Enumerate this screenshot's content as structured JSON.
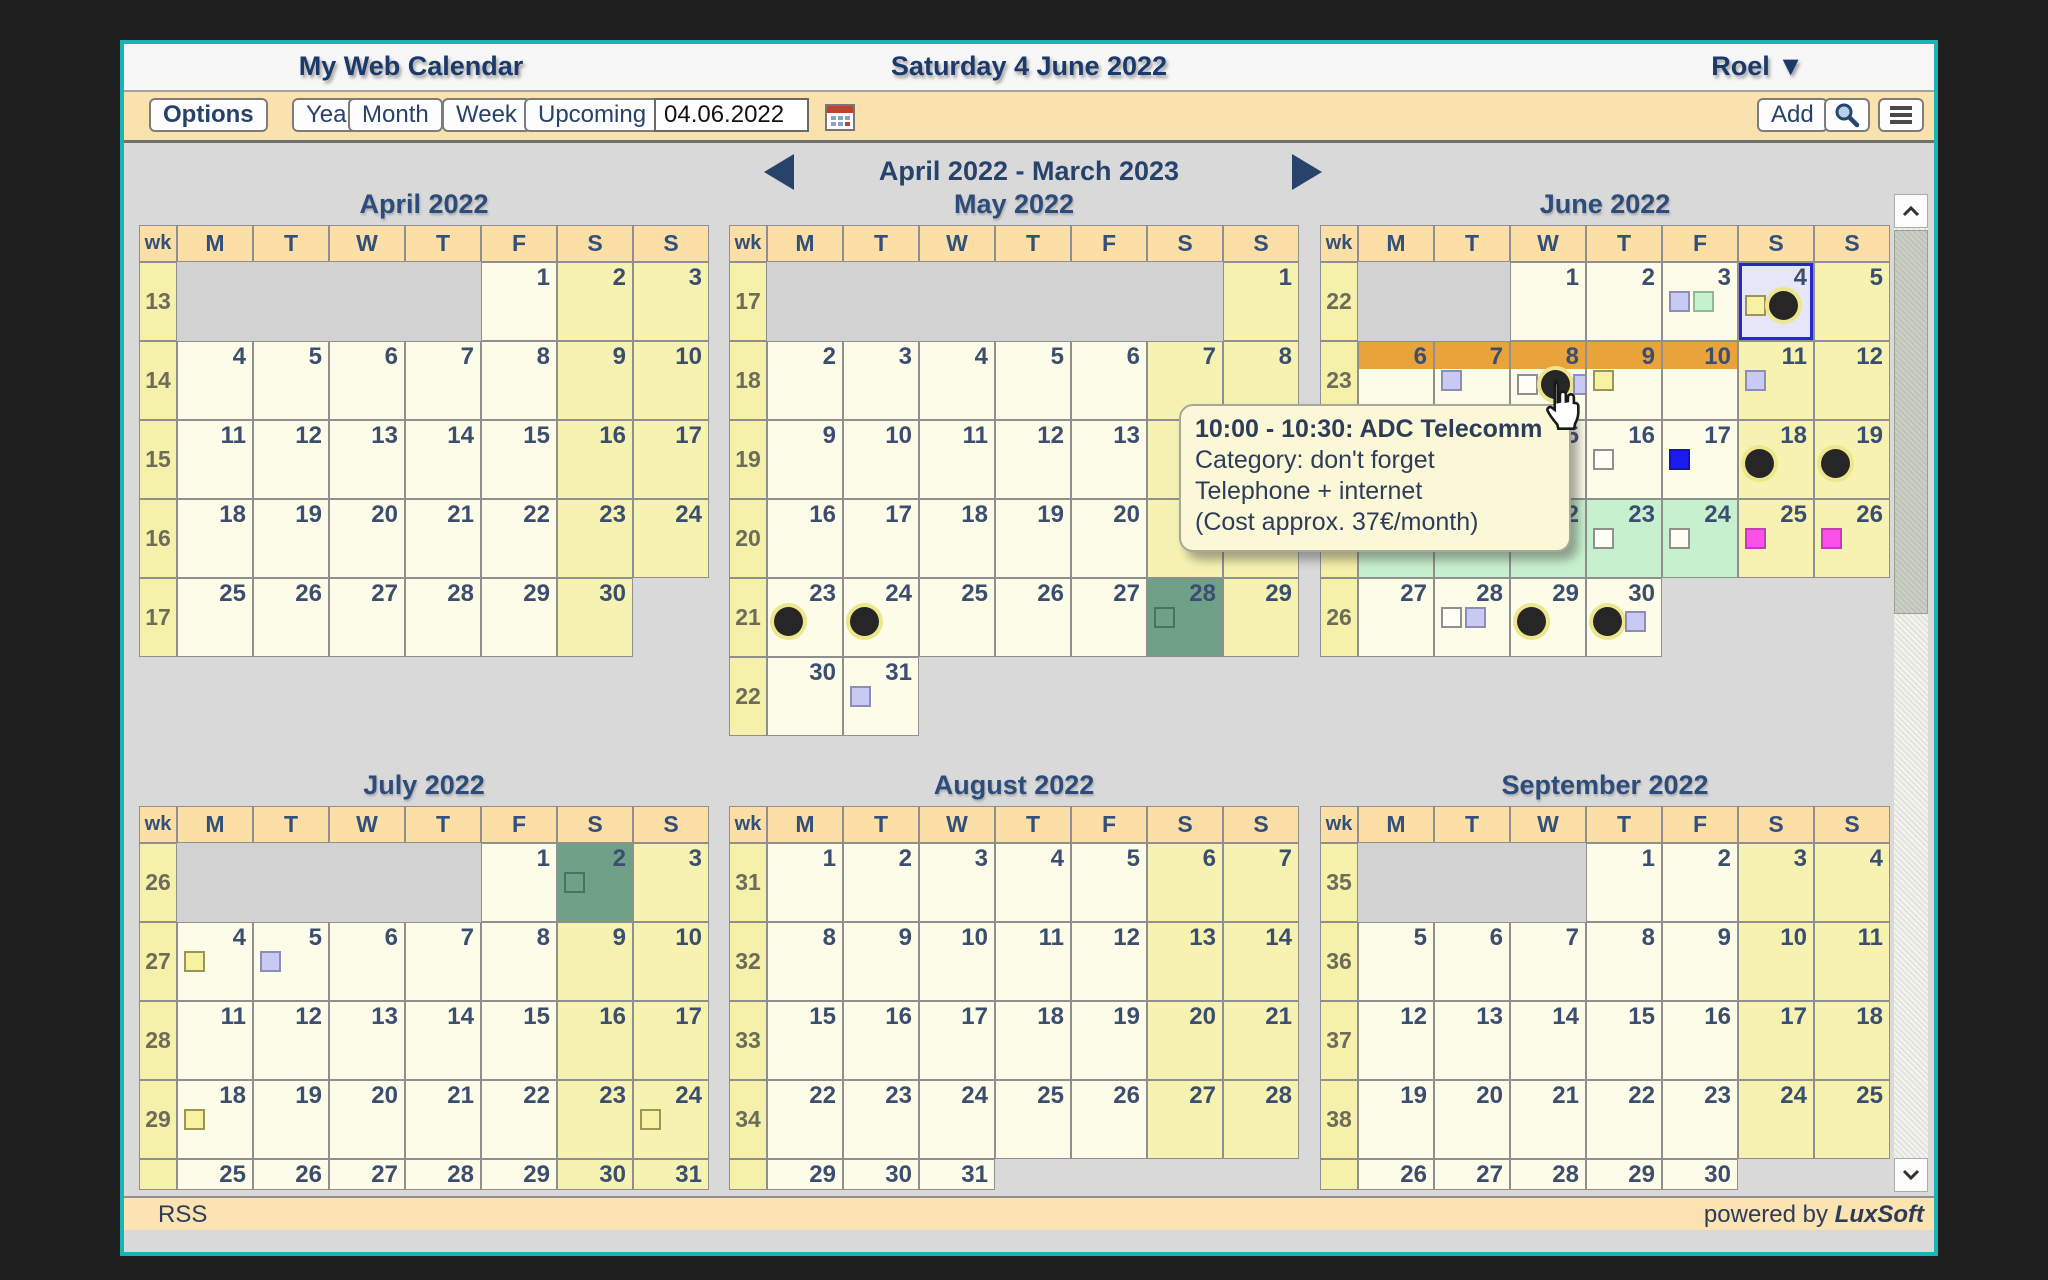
{
  "window": {
    "title_left": "My Web Calendar",
    "title_center": "Saturday 4 June 2022",
    "user": {
      "name": "Roel",
      "caret": "▼"
    }
  },
  "toolbar": {
    "options": "Options",
    "year": "Year",
    "month": "Month",
    "week": "Week",
    "upcoming": "Upcoming",
    "date_value": "04.06.2022",
    "add": "Add"
  },
  "nav": {
    "range_label": "April 2022 - March 2023"
  },
  "weekday_headers": [
    "wk",
    "M",
    "T",
    "W",
    "T",
    "F",
    "S",
    "S"
  ],
  "tooltip": {
    "line1": "10:00 - 10:30: ADC Telecomm",
    "line2": "Category: don't forget",
    "line3": "Telephone + internet",
    "line4": "(Cost approx. 37€/month)"
  },
  "footer": {
    "rss": "RSS",
    "powered_prefix": "powered by ",
    "powered_brand": "LuxSoft"
  },
  "colors": {
    "accent_border": "#1CB3B6",
    "toolbar_bg": "#FAE2AE",
    "selected_day": "#6FA189",
    "multiday_orange": "#E8A33B",
    "multiday_green": "#C7F1CE",
    "today_bg": "#E6E6F9",
    "today_border": "#2727CF"
  },
  "months": [
    {
      "title": "April 2022",
      "weeks": [
        {
          "num": 13,
          "days": [
            "e",
            "e",
            "e",
            "e",
            {
              "d": 1
            },
            {
              "d": 2
            },
            {
              "d": 3
            }
          ]
        },
        {
          "num": 14,
          "days": [
            4,
            5,
            6,
            7,
            8,
            9,
            10
          ]
        },
        {
          "num": 15,
          "days": [
            11,
            12,
            13,
            14,
            15,
            16,
            17
          ]
        },
        {
          "num": 16,
          "days": [
            18,
            19,
            20,
            21,
            22,
            23,
            24
          ]
        },
        {
          "num": 17,
          "days": [
            25,
            26,
            27,
            28,
            29,
            30,
            null
          ]
        }
      ]
    },
    {
      "title": "May 2022",
      "weeks": [
        {
          "num": 17,
          "days": [
            "e",
            "e",
            "e",
            "e",
            "e",
            "e",
            {
              "d": 1
            }
          ]
        },
        {
          "num": 18,
          "days": [
            2,
            3,
            4,
            5,
            6,
            7,
            8
          ]
        },
        {
          "num": 19,
          "days": [
            9,
            10,
            11,
            12,
            13,
            14,
            15
          ]
        },
        {
          "num": 20,
          "days": [
            16,
            17,
            18,
            19,
            20,
            21,
            22
          ]
        },
        {
          "num": 21,
          "days": [
            {
              "d": 23,
              "mk": [
                "dot"
              ]
            },
            {
              "d": 24,
              "mk": [
                "dot"
              ]
            },
            25,
            26,
            27,
            {
              "d": 28,
              "bg": "teal",
              "mk": [
                "tealsq"
              ]
            },
            29
          ]
        },
        {
          "num": 22,
          "days": [
            30,
            {
              "d": 31,
              "mk": [
                "lav"
              ]
            },
            null,
            null,
            null,
            null,
            null
          ]
        }
      ]
    },
    {
      "title": "June 2022",
      "weeks": [
        {
          "num": 22,
          "days": [
            "e",
            "e",
            {
              "d": 1
            },
            {
              "d": 2
            },
            {
              "d": 3,
              "mk": [
                "lav",
                "green"
              ]
            },
            {
              "d": 4,
              "today": 1,
              "mk": [
                "yellow",
                "dot"
              ]
            },
            {
              "d": 5
            }
          ]
        },
        {
          "num": 23,
          "days": [
            {
              "d": 6,
              "band": 1
            },
            {
              "d": 7,
              "band": 1,
              "mk": [
                "lav"
              ]
            },
            {
              "d": 8,
              "band": 1,
              "mk": [
                "ivory",
                "dot",
                "lav"
              ]
            },
            {
              "d": 9,
              "band": 1,
              "mk": [
                "yellow"
              ]
            },
            {
              "d": 10,
              "band": 1
            },
            {
              "d": 11,
              "mk": [
                "lav"
              ]
            },
            {
              "d": 12
            }
          ]
        },
        {
          "num": 24,
          "days": [
            13,
            14,
            15,
            {
              "d": 16,
              "mk": [
                "ivory"
              ]
            },
            {
              "d": 17,
              "mk": [
                "blue"
              ]
            },
            {
              "d": 18,
              "mk": [
                "dot"
              ]
            },
            {
              "d": 19,
              "mk": [
                "dot"
              ]
            }
          ]
        },
        {
          "num": 25,
          "days": [
            {
              "d": 20,
              "bg": "green"
            },
            {
              "d": 21,
              "bg": "green"
            },
            {
              "d": 22,
              "bg": "green",
              "mk": [
                "green"
              ]
            },
            {
              "d": 23,
              "bg": "green",
              "mk": [
                "ivory"
              ]
            },
            {
              "d": 24,
              "bg": "green",
              "mk": [
                "ivory"
              ]
            },
            {
              "d": 25,
              "mk": [
                "magenta"
              ]
            },
            {
              "d": 26,
              "mk": [
                "magenta"
              ]
            }
          ]
        },
        {
          "num": 26,
          "days": [
            27,
            {
              "d": 28,
              "mk": [
                "ivory",
                "lav"
              ]
            },
            {
              "d": 29,
              "mk": [
                "dot"
              ]
            },
            {
              "d": 30,
              "mk": [
                "dot",
                "lav"
              ]
            },
            null,
            null,
            null
          ]
        }
      ]
    },
    {
      "title": "July 2022",
      "weeks": [
        {
          "num": 26,
          "days": [
            "e",
            "e",
            "e",
            "e",
            {
              "d": 1
            },
            {
              "d": 2,
              "bg": "teal",
              "mk": [
                "tealsq"
              ]
            },
            {
              "d": 3
            }
          ]
        },
        {
          "num": 27,
          "days": [
            {
              "d": 4,
              "mk": [
                "yellow"
              ]
            },
            {
              "d": 5,
              "mk": [
                "lav"
              ]
            },
            6,
            7,
            8,
            9,
            10
          ]
        },
        {
          "num": 28,
          "days": [
            11,
            12,
            13,
            14,
            15,
            16,
            17
          ]
        },
        {
          "num": 29,
          "days": [
            {
              "d": 18,
              "mk": [
                "yellow"
              ]
            },
            19,
            20,
            21,
            22,
            23,
            {
              "d": 24,
              "mk": [
                "yellow"
              ]
            }
          ]
        },
        {
          "num": null,
          "partial": 1,
          "days": [
            25,
            26,
            27,
            28,
            29,
            30,
            31
          ]
        }
      ]
    },
    {
      "title": "August 2022",
      "weeks": [
        {
          "num": 31,
          "days": [
            1,
            2,
            3,
            4,
            5,
            6,
            7
          ]
        },
        {
          "num": 32,
          "days": [
            8,
            9,
            10,
            11,
            12,
            13,
            14
          ]
        },
        {
          "num": 33,
          "days": [
            15,
            16,
            17,
            18,
            19,
            20,
            21
          ]
        },
        {
          "num": 34,
          "days": [
            22,
            23,
            24,
            25,
            26,
            27,
            28
          ]
        },
        {
          "num": null,
          "partial": 1,
          "days": [
            29,
            30,
            31,
            null,
            null,
            null,
            null
          ]
        }
      ]
    },
    {
      "title": "September 2022",
      "weeks": [
        {
          "num": 35,
          "days": [
            "e",
            "e",
            "e",
            {
              "d": 1
            },
            {
              "d": 2
            },
            {
              "d": 3
            },
            {
              "d": 4
            }
          ]
        },
        {
          "num": 36,
          "days": [
            5,
            6,
            7,
            8,
            9,
            10,
            11
          ]
        },
        {
          "num": 37,
          "days": [
            12,
            13,
            14,
            15,
            16,
            17,
            18
          ]
        },
        {
          "num": 38,
          "days": [
            19,
            20,
            21,
            22,
            23,
            24,
            25
          ]
        },
        {
          "num": null,
          "partial": 1,
          "days": [
            26,
            27,
            28,
            29,
            30,
            null,
            null
          ]
        }
      ]
    }
  ]
}
